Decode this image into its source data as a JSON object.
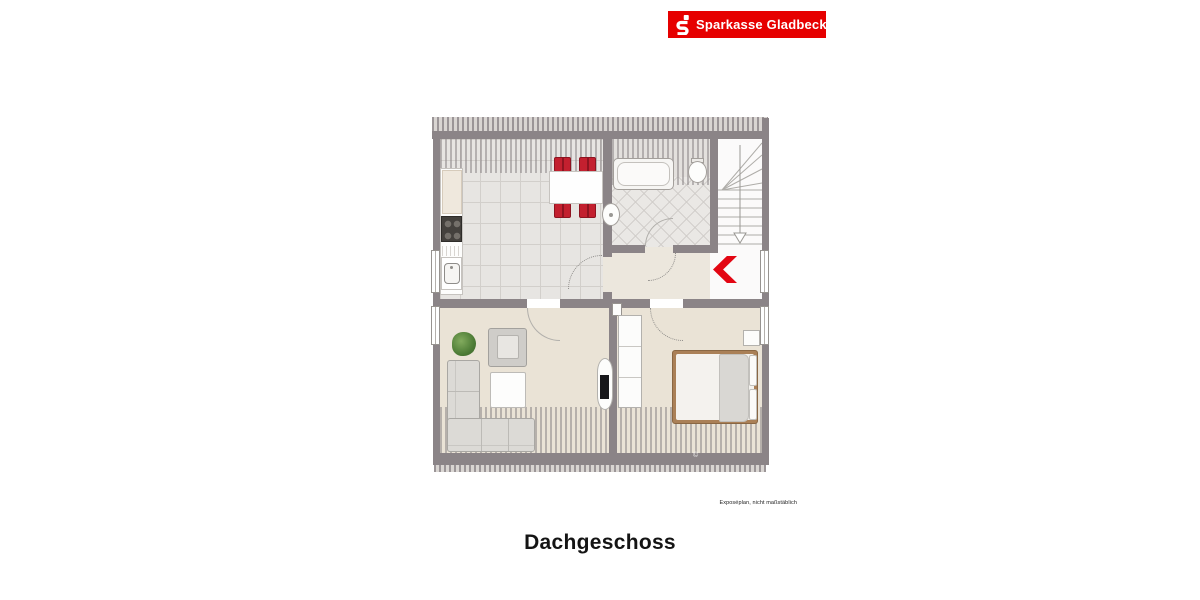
{
  "brand": {
    "name": "Sparkasse Gladbeck",
    "bar_color": "#e60000",
    "logo_icon": "sparkasse-s-icon"
  },
  "plan": {
    "title": "Dachgeschoss",
    "disclaimer": "Exposéplan, nicht maßstäblich",
    "watermark_symbol": "©",
    "rooms": [
      "kitchen-dining",
      "bathroom",
      "staircase",
      "hallway",
      "landing",
      "living-room",
      "bedroom"
    ],
    "furniture": [
      "dining-table",
      "dining-chairs-red",
      "kitchen-counter",
      "stove",
      "kitchen-sink",
      "bathtub",
      "toilet",
      "wash-basin",
      "corner-sofa",
      "armchair",
      "coffee-table",
      "plant",
      "tv-sideboard",
      "wardrobe",
      "double-bed",
      "nightstand",
      "red-chevron-marker",
      "stairs-down-arrow"
    ],
    "colors": {
      "accent_red": "#e30613",
      "chair_red": "#c3202f",
      "wall_gray": "#8b8487",
      "floor_beige": "#eae3d6",
      "tile_gray": "#e7e5e2"
    }
  }
}
